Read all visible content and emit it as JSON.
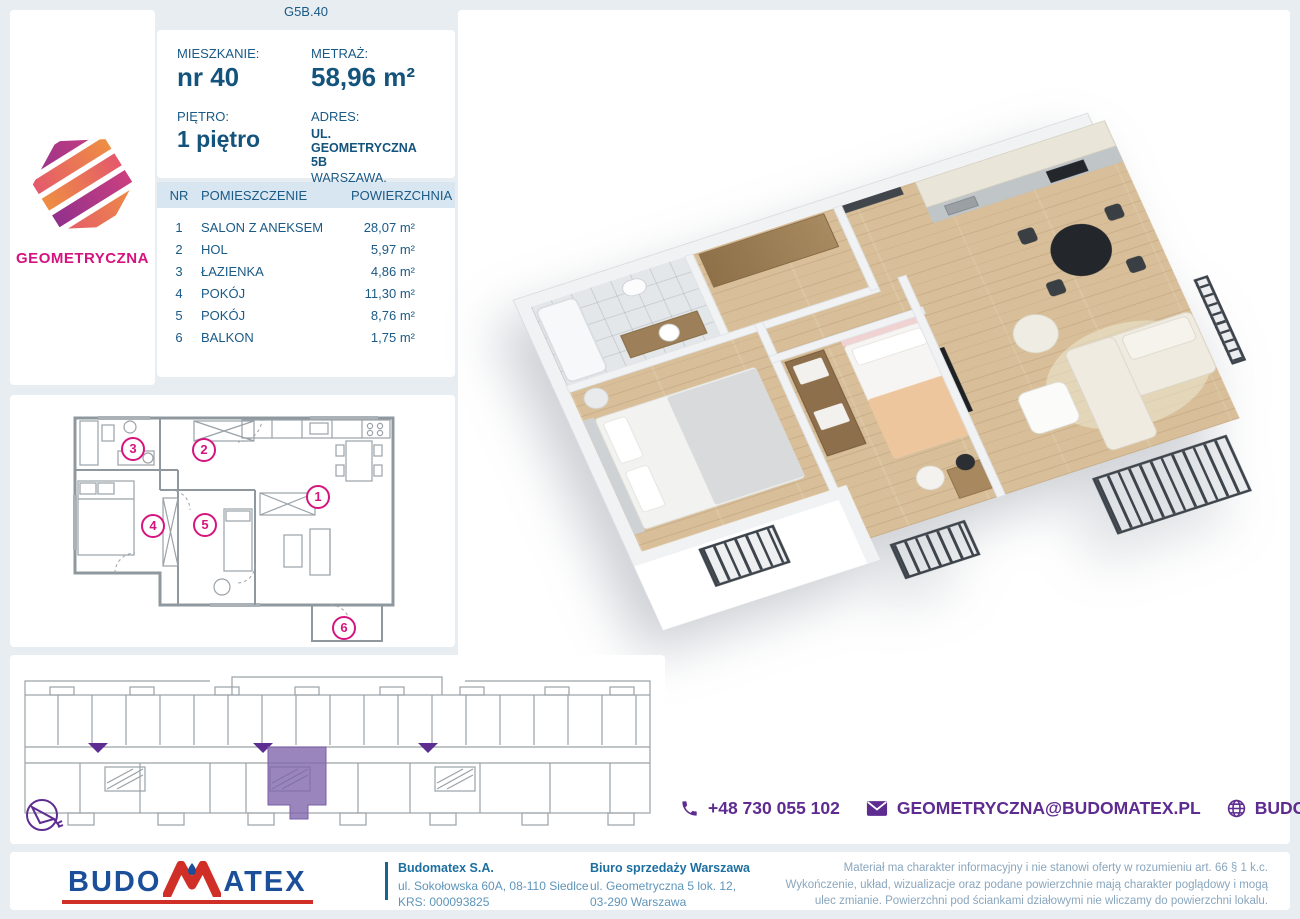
{
  "page": {
    "unit_code": "G5B.40"
  },
  "brand": {
    "project_name": "GEOMETRYCZNA"
  },
  "info": {
    "apartment_label": "MIESZKANIE:",
    "apartment_value": "nr 40",
    "area_label": "METRAŻ:",
    "area_value": "58,96 m²",
    "floor_label": "PIĘTRO:",
    "floor_value": "1 piętro",
    "address_label": "ADRES:",
    "address_line1": "UL. GEOMETRYCZNA 5B",
    "address_line2": "WARSZAWA, BIAŁOŁĘKA"
  },
  "rooms": {
    "headers": {
      "nr": "NR",
      "name": "POMIESZCZENIE",
      "area": "POWIERZCHNIA"
    },
    "rows": [
      {
        "nr": "1",
        "name": "SALON Z ANEKSEM",
        "area": "28,07 m²"
      },
      {
        "nr": "2",
        "name": "HOL",
        "area": "5,97 m²"
      },
      {
        "nr": "3",
        "name": "ŁAZIENKA",
        "area": "4,86 m²"
      },
      {
        "nr": "4",
        "name": "POKÓJ",
        "area": "11,30 m²"
      },
      {
        "nr": "5",
        "name": "POKÓJ",
        "area": "8,76 m²"
      },
      {
        "nr": "6",
        "name": "BALKON",
        "area": "1,75 m²"
      }
    ]
  },
  "plan2d": {
    "badges": [
      "1",
      "2",
      "3",
      "4",
      "5",
      "6"
    ]
  },
  "contact": {
    "phone": "+48 730 055 102",
    "email": "GEOMETRYCZNA@BUDOMATEX.PL",
    "website": "BUDOMATEX.PL"
  },
  "footer": {
    "logo_part1": "BUDO",
    "logo_part2": "ATEX",
    "company_name": "Budomatex S.A.",
    "company_address": "ul. Sokołowska 60A, 08-110 Siedlce",
    "company_krs": "KRS: 000093825",
    "office_name": "Biuro sprzedaży Warszawa",
    "office_address1": "ul. Geometryczna 5 lok. 12,",
    "office_address2": "03-290 Warszawa",
    "disclaimer": "Materiał ma charakter informacyjny i nie stanowi oferty w rozumieniu art. 66 § 1 k.c. Wykończenie, układ, wizualizacje oraz podane powierzchnie mają charakter poglądowy i mogą ulec zmianie. Powierzchni pod ściankami działowymi nie wliczamy do powierzchni lokalu."
  },
  "colors": {
    "accent_blue": "#1a5a86",
    "accent_purple": "#5e2c90",
    "accent_magenta": "#d6147e",
    "highlight_unit": "#8d76b5"
  }
}
